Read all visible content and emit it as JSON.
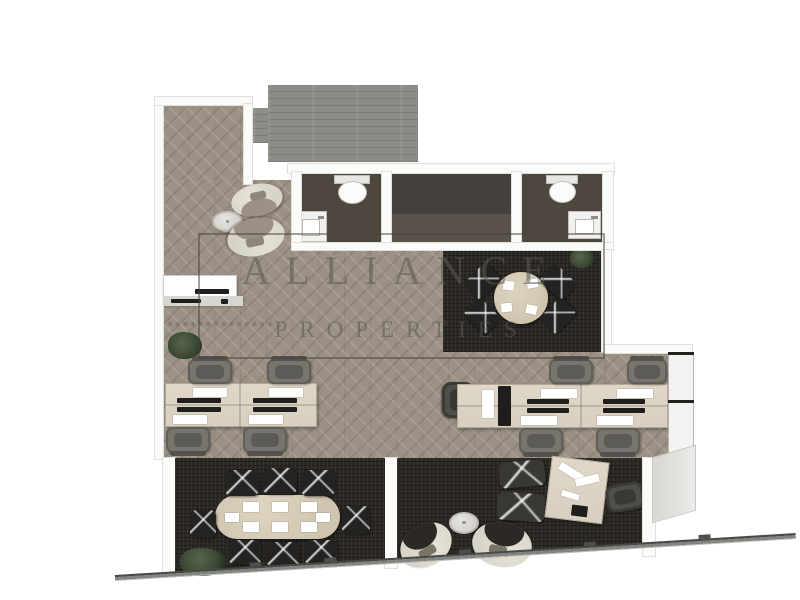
{
  "watermark": {
    "line1": "ALLIANCE",
    "line2": "PROPERTIES"
  },
  "colors": {
    "canvas": "#ffffff",
    "wood": "#9c9184",
    "deck": "#8d8d87",
    "carpet": "#2c2925",
    "bath": "#4e4740",
    "midroomtop": "#45403c",
    "midroombottom": "#59534c",
    "wall": "#fbfbfa",
    "walledge": "#e2e0dc",
    "desk": "#d8cfc0",
    "deskedge": "#b5aa97",
    "paper": "#ffffff",
    "device": "#1f1e1c",
    "taskchair": "#77756e",
    "darkchair": "#242321",
    "lounge": "#d8d3c8",
    "execchair": "#504e49",
    "meetingtable": "#cfc5af",
    "cabinet": "#f4f3f1",
    "band": "#6e716e",
    "plant": "#3c4a34",
    "watermarkink": "rgba(92,89,85,0.58)",
    "watermarkbox": "rgba(70,66,60,0.5)"
  }
}
